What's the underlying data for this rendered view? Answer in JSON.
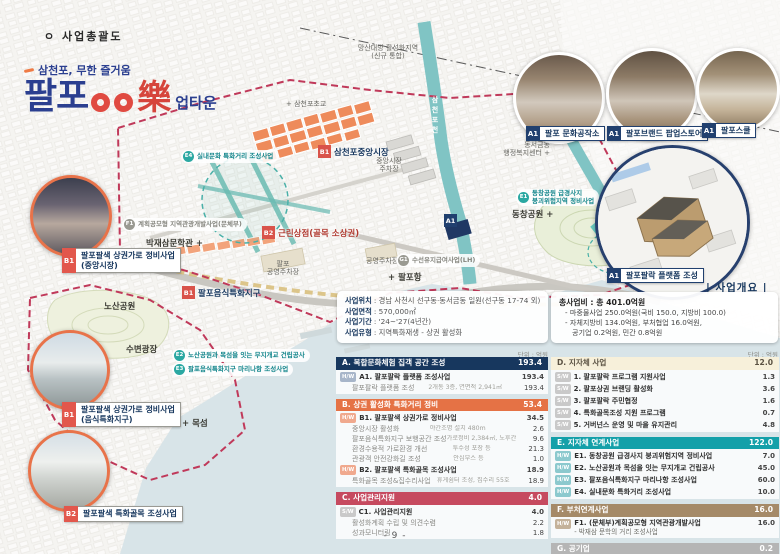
{
  "page": {
    "doc_title": "ㅇ 사업총괄도",
    "section_label": "| 사업개요 |",
    "unit_note": "단위 : 억원",
    "page_number": "- 9 -"
  },
  "logo": {
    "tagline": "삼천포, 무한 즐거움",
    "title_part1": "팔포",
    "title_rak": "樂",
    "title_suffix": "업타운"
  },
  "map": {
    "labels": {
      "activation_zone_1": "망산대방 활성화지역",
      "activation_zone_2": "(신규 통합)",
      "school": "+ 삼천포초교",
      "river": "삼천포천",
      "admin_center_1": "동서금동",
      "admin_center_2": "행정복지센터 +",
      "dongchang_park": "동창공원 +",
      "market_parking_1": "중앙시장",
      "market_parking_2": "주차장",
      "public_parking": "공영주차장",
      "palpo_parking_1": "팔포",
      "palpo_parking_2": "공영주차장",
      "palpo_port": "+ 팔포항",
      "bakjaesam": "박재삼문학관 +",
      "nosan_park": "노산공원",
      "waterfront_plaza": "수변광장",
      "mokseom": "+ 목섬"
    },
    "badges": {
      "e4": {
        "badge": "E4",
        "label": "실내문화 특화거리 조성사업"
      },
      "b1_market": {
        "badge": "B1",
        "label": "삼천포중앙시장"
      },
      "f1": {
        "badge": "F1",
        "label": "계획공모형 지역관광개발사업(문체부)"
      },
      "b2_shops": {
        "badge": "B2",
        "label": "근린상점(골목 소상권)"
      },
      "e1": {
        "badge": "E1",
        "label1": "동창공원 급경사지",
        "label2": "붕괴위험지역 정비사업"
      },
      "a1_site": {
        "badge": "A1"
      },
      "g1": {
        "badge": "G1",
        "label": "수선유지급여사업(LH)"
      },
      "b1_food": {
        "badge": "B1",
        "label": "팔포음식특화지구"
      },
      "e2": {
        "badge": "E2",
        "label": "노산공원과 목섬을 잇는 무지개교 건립공사"
      },
      "e3": {
        "badge": "E3",
        "label": "팔포음식특화지구 마리나항 조성사업"
      }
    }
  },
  "callouts_right": [
    {
      "badge": "A1",
      "label": "팔포 문화공작소"
    },
    {
      "badge": "A1",
      "label": "팔포브랜드 팝업스토어"
    },
    {
      "badge": "A1",
      "label": "팔포스쿨"
    },
    {
      "badge": "A1",
      "label": "팔포팔락 플랫폼 조성"
    }
  ],
  "callouts_left": [
    {
      "badge": "B1",
      "label": "팔포팔색 상권가로 정비사업",
      "sub": "(중앙시장)"
    },
    {
      "badge": "B1",
      "label": "팔포팔색 상권가로 정비사업",
      "sub": "(음식특화지구)"
    },
    {
      "badge": "B2",
      "label": "팔포팔색 특화골목 조성사업"
    }
  ],
  "overview": {
    "rows": [
      {
        "label": "사업위치",
        "value": ": 경남 사천시 선구동·동서금동 일원(선구동 17-74 외)"
      },
      {
        "label": "사업면적",
        "value": ": 570,000㎡"
      },
      {
        "label": "사업기간",
        "value": ": '24~'27(4년간)"
      },
      {
        "label": "사업유형",
        "value": ": 지역특화재생 - 상권 활성화"
      }
    ]
  },
  "budget": {
    "title": "총사업비 : 총 401.0억원",
    "lines": [
      "- 마중물사업 250.0억원(국비 150.0, 지방비 100.0)",
      "- 자체지방비 134.0억원, 부처협업 16.0억원,",
      "공기업 0.2억원, 민간 0.8억원"
    ]
  },
  "table_left": {
    "sections": [
      {
        "title": "A. 복합문화체험 집객 공간 조성",
        "total": "193.4",
        "rows": [
          {
            "badge": "H/W",
            "label": "A1. 팔포팔락 플랫폼 조성사업",
            "value": "193.4"
          },
          {
            "label": "팔포팔락 플랫폼 조성",
            "detail": "2개동 3층, 연면적 2,941㎡",
            "value": "193.4"
          }
        ]
      },
      {
        "title": "B. 상권 활성화 특화거리 정비",
        "total": "53.4",
        "rows": [
          {
            "badge": "H/W",
            "label": "B1. 팔포팔색 상권가로 정비사업",
            "value": "34.5"
          },
          {
            "label": "중앙시장 활성화",
            "detail": "야간조명 설치 480m",
            "value": "2.6"
          },
          {
            "label": "팔포음식특화지구 보행공간 조성",
            "detail": "가로정비 2,384㎡, 노후간판정비 30개소",
            "value": "9.6"
          },
          {
            "label": "환경수용적 가로환경 개선",
            "detail": "투수성 포장 등",
            "value": "21.3"
          },
          {
            "label": "관광객 안전강화길 조성",
            "detail": "안심부스 등",
            "value": "1.0"
          },
          {
            "badge": "H/W",
            "label": "B2. 팔포팔색 특화골목 조성사업",
            "value": "18.9"
          },
          {
            "label": "특화골목 조성&집수리사업",
            "detail": "휴게쉼터 조성, 집수리 55호",
            "value": "18.9"
          }
        ]
      },
      {
        "title": "C. 사업관리지원",
        "total": "4.0",
        "rows": [
          {
            "badge": "S/W",
            "label": "C1. 사업관리지원",
            "value": "4.0"
          },
          {
            "label": "활성화계획 수립 및 의견수렴",
            "value": "2.2"
          },
          {
            "label": "성과모니터링",
            "value": "1.8"
          }
        ]
      }
    ]
  },
  "table_right": {
    "sections": [
      {
        "title": "D. 지자체 사업",
        "total": "12.0",
        "rows": [
          {
            "badge": "S/W",
            "label": "1. 팔포팔락 프로그램 지원사업",
            "value": "1.3"
          },
          {
            "badge": "S/W",
            "label": "2. 팔포상권 브랜딩 활성화",
            "value": "3.6"
          },
          {
            "badge": "S/W",
            "label": "3. 팔포팔락 주민협정",
            "value": "1.6"
          },
          {
            "badge": "S/W",
            "label": "4. 특화골목조성 지원 프로그램",
            "value": "0.7"
          },
          {
            "badge": "S/W",
            "label": "5. 거버넌스 운영 및 마을 유지관리",
            "value": "4.8"
          }
        ]
      },
      {
        "title": "E. 지자체 연계사업",
        "total": "122.0",
        "rows": [
          {
            "badge": "H/W",
            "label": "E1. 동창공원 급경사지 붕괴위험지역 정비사업",
            "value": "7.0"
          },
          {
            "badge": "H/W",
            "label": "E2. 노산공원과 목섬을 잇는 무지개교 건립공사",
            "value": "45.0"
          },
          {
            "badge": "H/W",
            "label": "E3. 팔포음식특화지구 마리나항 조성사업",
            "value": "60.0"
          },
          {
            "badge": "H/W",
            "label": "E4. 실내문화 특화거리 조성사업",
            "value": "10.0"
          }
        ]
      },
      {
        "title": "F. 부처연계사업",
        "total": "16.0",
        "rows": [
          {
            "badge": "H/W",
            "label": "F1. (문체부)계획공모형 지역관광개발사업",
            "detail2": "- 박재삼 문학의 거리 조성사업",
            "value": "16.0"
          }
        ]
      },
      {
        "title": "G. 공기업",
        "total": "0.2",
        "rows": [
          {
            "badge": "H/W",
            "label": "G1. 수선유지급여사업(LH)",
            "value": "0.2"
          }
        ]
      }
    ]
  }
}
